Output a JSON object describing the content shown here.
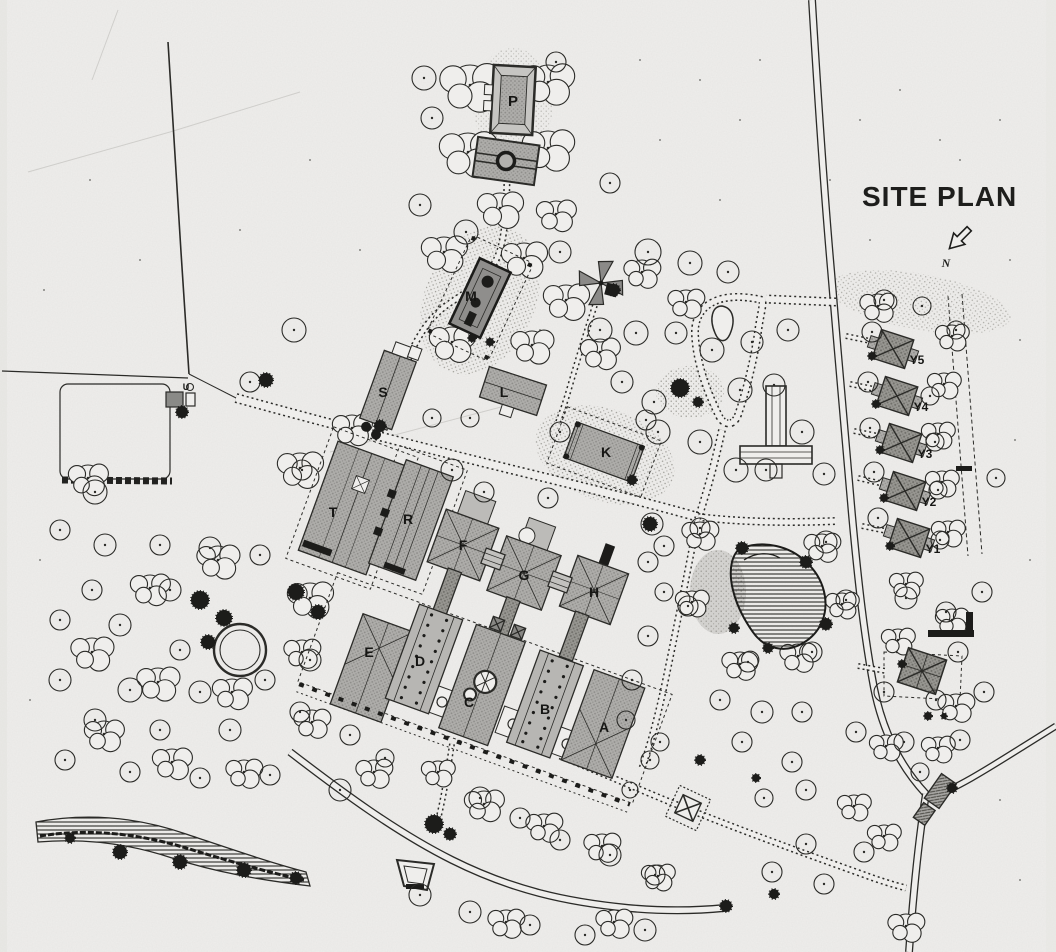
{
  "title": "SITE PLAN",
  "north": {
    "label": "N"
  },
  "labels": {
    "A": "A",
    "B": "B",
    "C": "C",
    "D": "D",
    "E": "E",
    "F": "F",
    "G": "G",
    "H": "H",
    "K": "K",
    "L": "L",
    "M": "M",
    "P": "P",
    "R": "R",
    "S": "S",
    "T": "T",
    "U": "U",
    "Y1": "Y1",
    "Y2": "Y2",
    "Y3": "Y3",
    "Y4": "Y4",
    "Y5": "Y5"
  },
  "colors": {
    "paper": "#efeeec",
    "ink": "#2b2b28",
    "building_fill": "#aeadaa",
    "building_dark": "#999890",
    "label_ink": "#161614"
  }
}
